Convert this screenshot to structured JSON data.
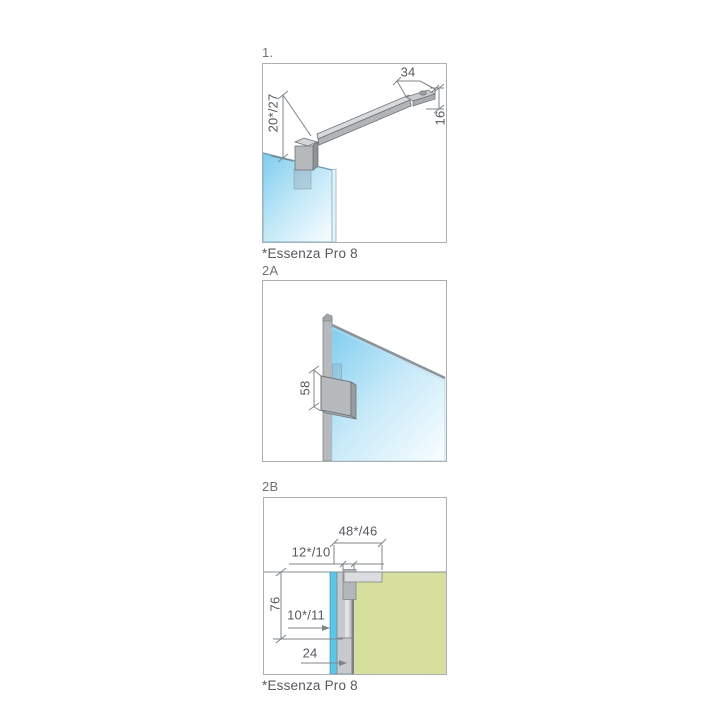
{
  "figure1": {
    "label": "1.",
    "dim_glass_to_bar": "20*/27",
    "dim_bracket_width": "34",
    "dim_bar_height": "16",
    "footnote": "*Essenza Pro 8"
  },
  "figure2a": {
    "label": "2A",
    "dim_bracket_height": "58"
  },
  "figure2b": {
    "label": "2B",
    "dim_wall_offset": "48*/46",
    "dim_adjustment": "12*/10",
    "dim_profile_length": "76",
    "dim_glass_offset": "10*/11",
    "dim_profile_width": "24",
    "footnote": "*Essenza Pro 8"
  },
  "colors": {
    "glass_blue": "#5cc5ea",
    "wall_green": "#d6df9e",
    "profile_gray": "#c7c9cb",
    "line_gray": "#7e8589",
    "text_gray": "#55595e",
    "label_gray": "#6e7377",
    "border_gray": "#aaafb3"
  }
}
